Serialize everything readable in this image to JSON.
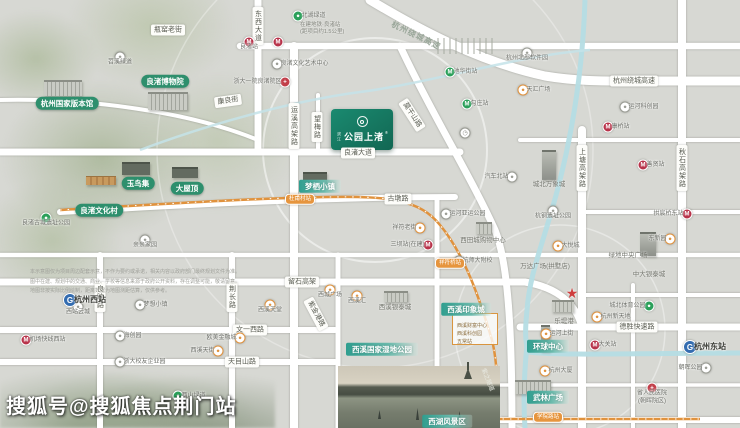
{
  "watermark": "搜狐号@搜狐焦点荆门站",
  "project": {
    "prefix": "滨江",
    "name": "公园上渚",
    "reg": "®"
  },
  "colors": {
    "metro_red": "#b8334a",
    "station_green": "#2ba05a",
    "park_green": "#2ba05a",
    "poi_orange": "#e0923d",
    "rail_blue": "#336cb0",
    "hospital_red": "#c23f4a",
    "label_green": "#2e8f6d",
    "teal": "#2f9e8f",
    "project_green": "#15806a",
    "canal_blue": "#b5dde4",
    "capsule_orange": "#e6953e",
    "star_red": "#cf3e3e"
  },
  "road_labels": [
    {
      "t": "东西大道",
      "x": 258,
      "y": 26,
      "o": "v"
    },
    {
      "t": "瓶窑老街",
      "x": 168,
      "y": 30,
      "o": "h"
    },
    {
      "t": "康良街",
      "x": 228,
      "y": 101,
      "o": "h",
      "r": -8
    },
    {
      "t": "运溪高架路",
      "x": 294,
      "y": 126,
      "o": "v"
    },
    {
      "t": "望梅路",
      "x": 317,
      "y": 127,
      "o": "v"
    },
    {
      "t": "良渚大道",
      "x": 358,
      "y": 153,
      "o": "h"
    },
    {
      "t": "莫干山路",
      "x": 412,
      "y": 115,
      "o": "h",
      "r": 57
    },
    {
      "t": "古墩路",
      "x": 398,
      "y": 199,
      "o": "h"
    },
    {
      "t": "杭州绕城高速",
      "x": 634,
      "y": 81,
      "o": "h"
    },
    {
      "t": "杭州绕城高速",
      "x": 416,
      "y": 36,
      "o": "h",
      "r": 26,
      "s": "hw"
    },
    {
      "t": "上塘高架路",
      "x": 582,
      "y": 168,
      "o": "v"
    },
    {
      "t": "秋石高架路",
      "x": 682,
      "y": 168,
      "o": "v"
    },
    {
      "t": "留石高架",
      "x": 302,
      "y": 282,
      "o": "h"
    },
    {
      "t": "良睦路",
      "x": 100,
      "y": 297,
      "o": "v"
    },
    {
      "t": "荆长路",
      "x": 232,
      "y": 297,
      "o": "v"
    },
    {
      "t": "文一西路",
      "x": 250,
      "y": 330,
      "o": "h"
    },
    {
      "t": "天目山路",
      "x": 242,
      "y": 362,
      "o": "h"
    },
    {
      "t": "德胜快速路",
      "x": 637,
      "y": 327,
      "o": "h"
    },
    {
      "t": "紫金港路",
      "x": 316,
      "y": 314,
      "o": "h",
      "r": 62
    },
    {
      "t": "紫之隧道",
      "x": 487,
      "y": 380,
      "o": "h",
      "r": 68,
      "s": "tunnel"
    }
  ],
  "places_green": [
    {
      "t": "杭州国家版本馆",
      "x": 67,
      "y": 103
    },
    {
      "t": "良渚博物院",
      "x": 165,
      "y": 81
    },
    {
      "t": "玉鸟集",
      "x": 138,
      "y": 183
    },
    {
      "t": "大屋顶",
      "x": 187,
      "y": 188
    },
    {
      "t": "良渚文化村",
      "x": 99,
      "y": 210
    }
  ],
  "places_teal": [
    {
      "t": "梦栖小镇",
      "x": 320,
      "y": 186
    },
    {
      "t": "西溪印象城",
      "x": 466,
      "y": 309
    },
    {
      "t": "西溪国家湿地公园",
      "x": 382,
      "y": 349
    },
    {
      "t": "环球中心",
      "x": 548,
      "y": 346
    },
    {
      "t": "武林广场",
      "x": 548,
      "y": 397
    },
    {
      "t": "西湖风景区",
      "x": 447,
      "y": 421
    }
  ],
  "pois": [
    {
      "x": 249,
      "y": 42,
      "icon": "metro",
      "label": "良渚站",
      "side": "b"
    },
    {
      "x": 278,
      "y": 42,
      "icon": "metro",
      "label": "",
      "side": "r"
    },
    {
      "x": 608,
      "y": 127,
      "icon": "metro",
      "label": "康桥站",
      "side": "r"
    },
    {
      "x": 643,
      "y": 165,
      "icon": "metro",
      "label": "善贤站",
      "side": "r"
    },
    {
      "x": 687,
      "y": 214,
      "icon": "metro",
      "label": "拱宸桥东站",
      "side": "l"
    },
    {
      "x": 595,
      "y": 345,
      "icon": "metro",
      "label": "大关站",
      "side": "r"
    },
    {
      "x": 428,
      "y": 245,
      "icon": "metro",
      "label": "三坝站(在建)",
      "side": "l"
    },
    {
      "x": 26,
      "y": 340,
      "icon": "metro",
      "label": "机场快线西站",
      "side": "r"
    },
    {
      "x": 450,
      "y": 72,
      "icon": "stn",
      "label": "池华街站",
      "side": "r"
    },
    {
      "x": 467,
      "y": 104,
      "icon": "stn",
      "label": "勾庄站",
      "side": "r"
    },
    {
      "x": 298,
      "y": 16,
      "icon": "park",
      "label": "北湖绿道",
      "side": "r"
    },
    {
      "x": 46,
      "y": 218,
      "icon": "park",
      "label": "良渚古城遗址公园",
      "side": "b"
    },
    {
      "x": 649,
      "y": 306,
      "icon": "park",
      "label": "城北体育公园",
      "side": "l"
    },
    {
      "x": 178,
      "y": 396,
      "icon": "park",
      "label": "西山绿道",
      "side": "r"
    },
    {
      "x": 523,
      "y": 90,
      "icon": "mall",
      "label": "天汇广场",
      "side": "r"
    },
    {
      "x": 558,
      "y": 246,
      "icon": "mall",
      "label": "大悦城",
      "side": "r"
    },
    {
      "x": 546,
      "y": 334,
      "icon": "mall",
      "label": "运河上街",
      "side": "r"
    },
    {
      "x": 597,
      "y": 317,
      "icon": "mall",
      "label": "杭州新天地",
      "side": "r"
    },
    {
      "x": 545,
      "y": 371,
      "icon": "mall",
      "label": "杭州大厦",
      "side": "r"
    },
    {
      "x": 670,
      "y": 239,
      "icon": "mall",
      "label": "东新园",
      "side": "l"
    },
    {
      "x": 420,
      "y": 228,
      "icon": "mall",
      "label": "祥符老街",
      "side": "l"
    },
    {
      "x": 357,
      "y": 296,
      "icon": "mall",
      "label": "西溪汇",
      "side": "b"
    },
    {
      "x": 330,
      "y": 290,
      "icon": "mall",
      "label": "西城广场",
      "side": "b"
    },
    {
      "x": 270,
      "y": 305,
      "icon": "mall",
      "label": "西溪天堂",
      "side": "b"
    },
    {
      "x": 218,
      "y": 351,
      "icon": "mall",
      "label": "西溪天街",
      "side": "l"
    },
    {
      "x": 240,
      "y": 338,
      "icon": "mall",
      "label": "欧美金融城",
      "side": "l"
    },
    {
      "x": 120,
      "y": 57,
      "icon": "poi",
      "label": "苕溪绿道",
      "side": "b"
    },
    {
      "x": 277,
      "y": 64,
      "icon": "poi",
      "label": "良渚文化艺术中心",
      "side": "r"
    },
    {
      "x": 145,
      "y": 240,
      "icon": "poi",
      "label": "亲亲家园",
      "side": "b"
    },
    {
      "x": 527,
      "y": 53,
      "icon": "poi",
      "label": "杭州北部软件园",
      "side": "b"
    },
    {
      "x": 625,
      "y": 107,
      "icon": "poi",
      "label": "运河科创园",
      "side": "r"
    },
    {
      "x": 512,
      "y": 177,
      "icon": "poi",
      "label": "汽车北站",
      "side": "l"
    },
    {
      "x": 553,
      "y": 211,
      "icon": "poi",
      "label": "杭钢遗址公园",
      "side": "b"
    },
    {
      "x": 446,
      "y": 214,
      "icon": "poi",
      "label": "运河亚运公园",
      "side": "r"
    },
    {
      "x": 459,
      "y": 261,
      "icon": "poi",
      "label": "杭师大附校",
      "side": "r"
    },
    {
      "x": 78,
      "y": 307,
      "icon": "poi",
      "label": "西站云城",
      "side": "b"
    },
    {
      "x": 140,
      "y": 305,
      "icon": "poi",
      "label": "梦想小镇",
      "side": "r"
    },
    {
      "x": 120,
      "y": 336,
      "icon": "poi",
      "label": "海创园",
      "side": "r"
    },
    {
      "x": 120,
      "y": 362,
      "icon": "poi",
      "label": "浙大校友企业园",
      "side": "r"
    },
    {
      "x": 706,
      "y": 368,
      "icon": "poi",
      "label": "朝晖公园",
      "side": "l"
    },
    {
      "x": 465,
      "y": 133,
      "icon": "clock",
      "label": "",
      "side": "r"
    },
    {
      "x": 70,
      "y": 300,
      "icon": "rail",
      "label": "杭州西站",
      "side": "r",
      "big": true
    },
    {
      "x": 690,
      "y": 347,
      "icon": "rail",
      "label": "杭州东站",
      "side": "r",
      "big": true
    },
    {
      "x": 285,
      "y": 82,
      "icon": "hosp",
      "label": "浙大一院良渚院区",
      "side": "l"
    },
    {
      "x": 652,
      "y": 388,
      "icon": "hosp",
      "label": "省人民医院|(朝晖院区)",
      "side": "b"
    }
  ],
  "star": {
    "x": 572,
    "y": 293
  },
  "building_labels": [
    {
      "t": "城北万象城",
      "x": 549,
      "y": 183
    },
    {
      "t": "万达广场(拱墅店)",
      "x": 545,
      "y": 265
    },
    {
      "t": "中大银泰城",
      "x": 649,
      "y": 273
    },
    {
      "t": "绿地中央广场",
      "x": 628,
      "y": 254
    },
    {
      "t": "西田城购物中心",
      "x": 483,
      "y": 239
    },
    {
      "t": "西溪银泰城",
      "x": 395,
      "y": 306
    },
    {
      "t": "乐堤港",
      "x": 564,
      "y": 320
    }
  ],
  "buildings": [
    {
      "x": 44,
      "y": 80,
      "w": 38,
      "h": 16,
      "s": "light"
    },
    {
      "x": 148,
      "y": 92,
      "w": 40,
      "h": 18,
      "s": "light"
    },
    {
      "x": 122,
      "y": 162,
      "w": 28,
      "h": 13,
      "s": "dark"
    },
    {
      "x": 172,
      "y": 167,
      "w": 26,
      "h": 11,
      "s": "dark"
    },
    {
      "x": 86,
      "y": 176,
      "w": 30,
      "h": 9,
      "s": "roof"
    },
    {
      "x": 303,
      "y": 172,
      "w": 24,
      "h": 11,
      "s": "dark"
    },
    {
      "x": 542,
      "y": 150,
      "w": 14,
      "h": 30,
      "s": "tower"
    },
    {
      "x": 640,
      "y": 232,
      "w": 16,
      "h": 24,
      "s": "tower"
    },
    {
      "x": 384,
      "y": 291,
      "w": 24,
      "h": 11,
      "s": "light"
    },
    {
      "x": 552,
      "y": 300,
      "w": 22,
      "h": 12,
      "s": "light"
    },
    {
      "x": 541,
      "y": 325,
      "w": 9,
      "h": 26,
      "s": "tower"
    },
    {
      "x": 515,
      "y": 380,
      "w": 36,
      "h": 14,
      "s": "light"
    },
    {
      "x": 476,
      "y": 222,
      "w": 16,
      "h": 12,
      "s": "light"
    },
    {
      "x": 437,
      "y": 38,
      "w": 58,
      "h": 16,
      "s": "sketch"
    }
  ],
  "capsules": [
    {
      "t": "杜甫村站",
      "x": 300,
      "y": 199
    },
    {
      "t": "祥符桥站",
      "x": 450,
      "y": 263
    },
    {
      "t": "学院路站",
      "x": 548,
      "y": 417
    }
  ],
  "annotations": [
    {
      "x": 300,
      "y": 22,
      "lines": [
        "在建地铁·良渚站",
        "(距项目约1.5公里)"
      ]
    }
  ],
  "legend": {
    "x": 452,
    "y": 313,
    "w": 46,
    "h": 32,
    "rows": [
      "西溪财富中心",
      "西溪科创园",
      "五常站"
    ]
  },
  "disclaimer": [
    "本示意图仅为项目周边配套示意，不作为要约或承诺，相关内容以政府部门最终规划文件为准。",
    "图中在建、规划中的交通、商业、学校等信息来源于政府公开资料，存在调整可能，敬请留意。",
    "地图非按实际比例绘制，距离数据为地图测距估算，仅供参考。"
  ]
}
